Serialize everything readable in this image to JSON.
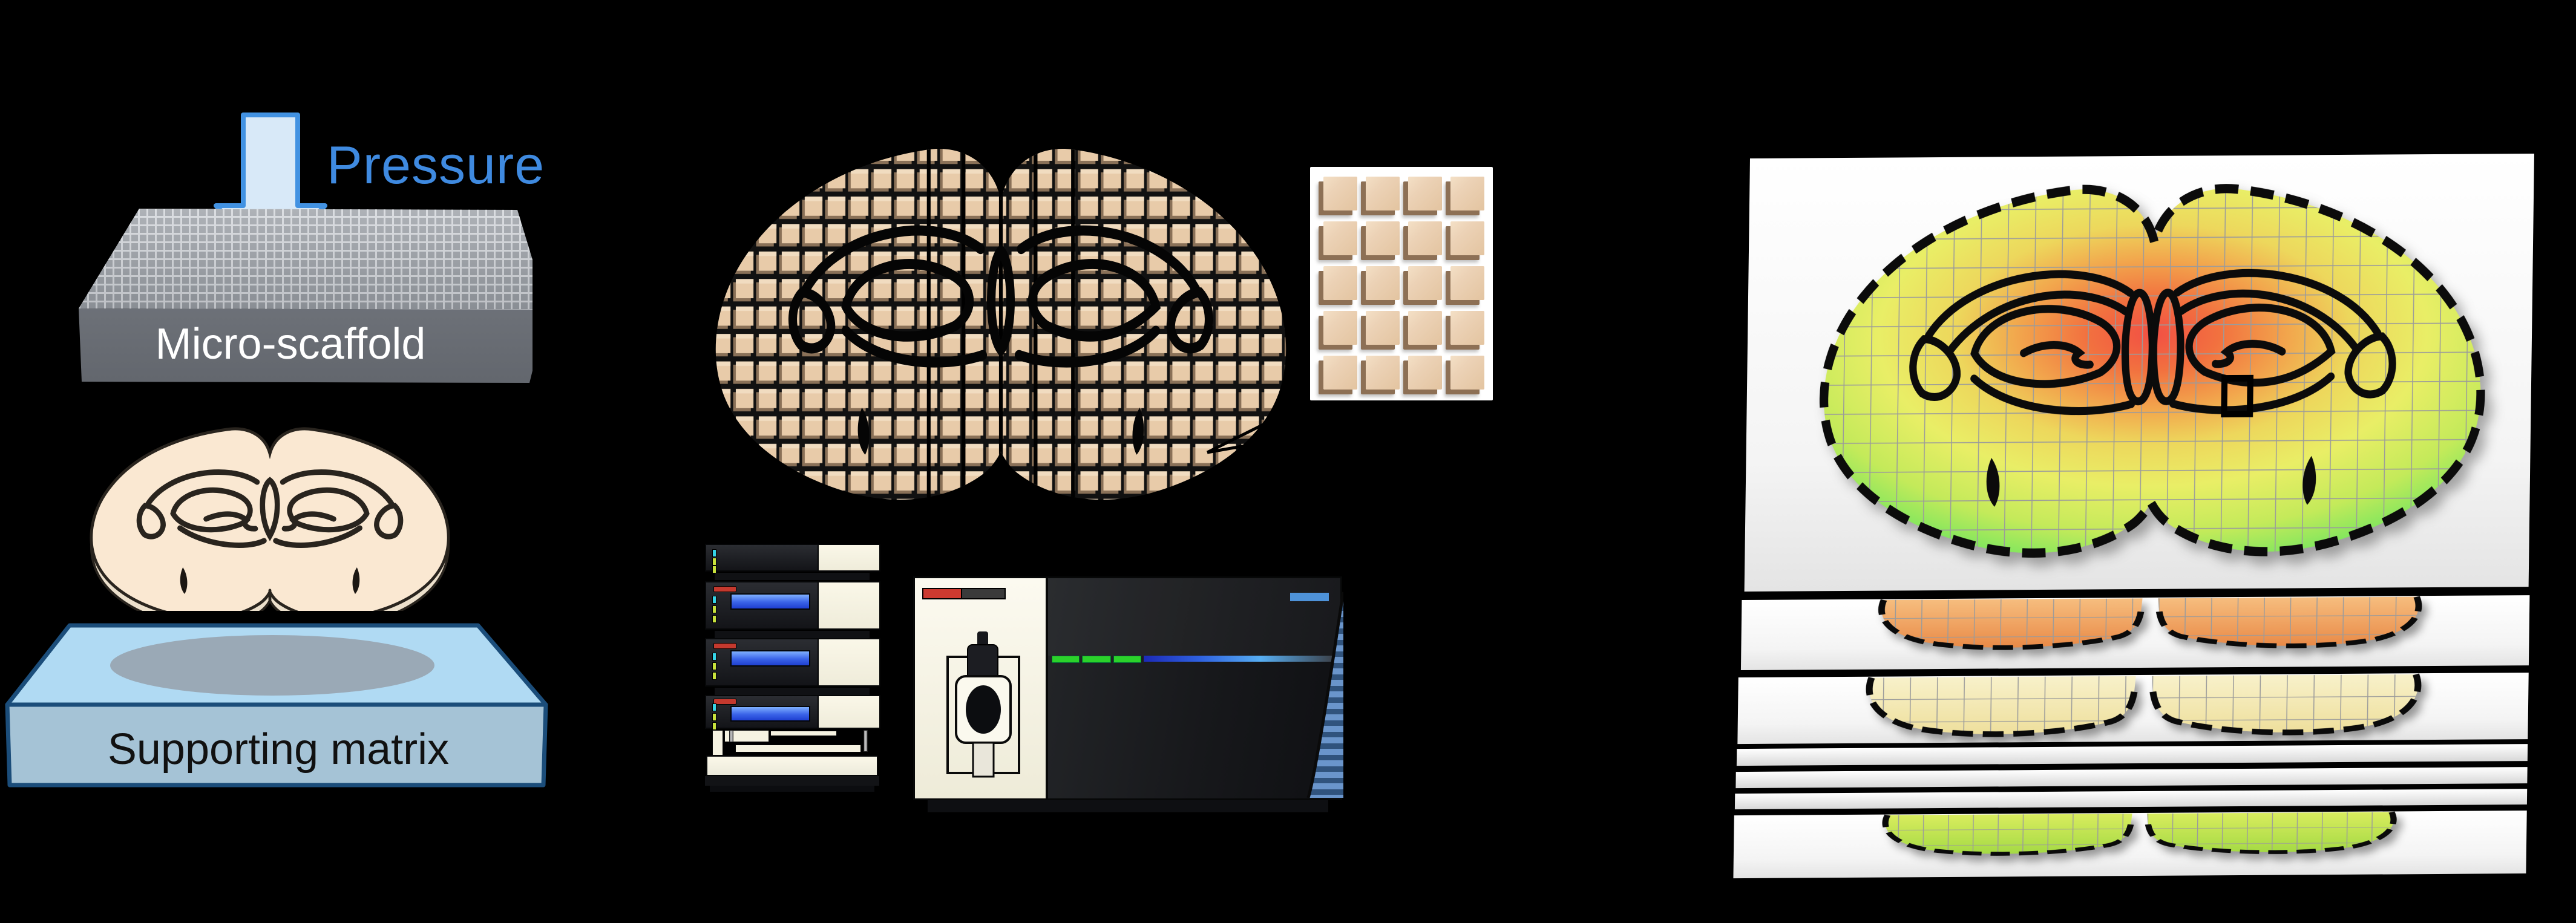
{
  "figure_title": "Micro-scaffold brain sectioning and LC-MS spatial mapping workflow",
  "background_color": "#000000",
  "scaffold_panel": {
    "pressure_label": "Pressure",
    "pressure_text_color": "#3f8ae0",
    "arrow_fill": "#d8e9f8",
    "arrow_stroke": "#4292e2",
    "scaffold_label": "Micro-scaffold",
    "scaffold_label_color": "#ffffff",
    "scaffold_face_color": "#6f737a",
    "tissue_fill": "#fae8d2",
    "matrix_label": "Supporting matrix",
    "matrix_label_color": "#111111",
    "matrix_top_color": "#b0daf3",
    "matrix_front_color": "#a5c3d6",
    "matrix_outline_color": "#1b4d7a",
    "matrix_shadow_ellipse_color": "#9aa9b6"
  },
  "sectioning_panel": {
    "cube_face_color": "#e8cba9",
    "cube_gap_color": "#9d8a74",
    "inset_rows": 5,
    "inset_columns": 4,
    "inset_box_color": "#ffffff"
  },
  "instrument_panel": {
    "hplc_panel_color": "#f6f3e2",
    "hplc_screen_color": "#2a51e0",
    "hplc_button_color": "#c4392e",
    "hplc_led_colors": [
      "#35d5e8",
      "#c8e23c",
      "#c8e23c"
    ],
    "ms_panel_color": "#f8f5e8",
    "ms_body_color": "#1d1f22",
    "ms_stripe_green": "#2bd22b",
    "ms_stripe_blue": "#3b82e6",
    "ms_logo_color": "#4e92d8",
    "ms_side_stripe_light": "#6a95cb",
    "ms_side_stripe_dark": "#30537d"
  },
  "maps_panel": {
    "slide_color": "#ffffff",
    "grid_color": "#9b9b9b",
    "heatmap_colors": [
      "#5fe25c",
      "#e9ee66",
      "#f2a44c",
      "#f25044"
    ],
    "partial_section_tints": [
      "#ee9550",
      "#f3e6a6",
      "#b9e048"
    ]
  }
}
